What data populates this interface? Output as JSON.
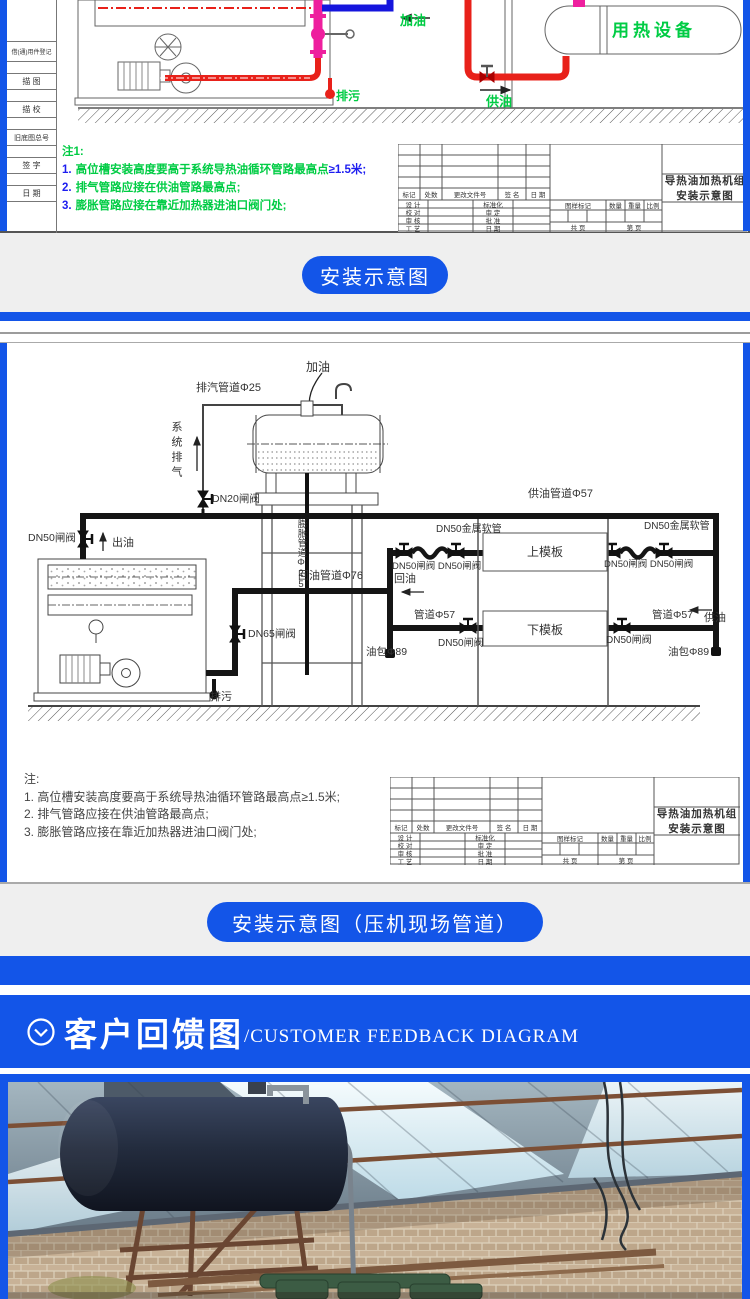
{
  "colors": {
    "accent_blue": "#1355e8",
    "diagram_green": "#00cc44",
    "note_blue": "#1d1df0",
    "pipe_red": "#e8211a",
    "pipe_magenta": "#ee1f9e",
    "pipe_blue": "#1515dd"
  },
  "drawing_frame": {
    "side_labels": [
      "借(通)用件登记",
      "描 图",
      "描 校",
      "旧底图总号",
      "签 字",
      "日 期"
    ]
  },
  "titleblock": {
    "row_header": [
      "标记",
      "处数",
      "更改文件号",
      "签 名",
      "日 期"
    ],
    "col_left": [
      "设 计",
      "校 对",
      "审 核",
      "工 艺"
    ],
    "col_mid": [
      "标准化",
      "审 定",
      "批 准",
      "日 期"
    ],
    "mark_header": [
      "图样标记",
      "数量",
      "重量",
      "比例"
    ],
    "pages": [
      "共  页",
      "第  页"
    ],
    "title": "导热油加热机组安装示意图"
  },
  "diagram1": {
    "labels": {
      "add_oil": "加油",
      "drain": "排污",
      "supply_oil": "供油",
      "heat_device": "用热设备"
    },
    "notes": {
      "head": "注1:",
      "n1": "1.",
      "t1": "高位槽安装高度要高于系统导热油循环管路最高点",
      "hl1": "≥1.5米;",
      "n2": "2.",
      "t2": "排气管路应接在供油管路最高点;",
      "n3": "3.",
      "t3": "膨胀管路应接在靠近加热器进油口阀门处;"
    }
  },
  "button1": {
    "label": "安装示意图"
  },
  "diagram2": {
    "labels": {
      "add_oil": "加油",
      "exhaust_pipe": "排汽管道Φ25",
      "system_vent": "系统排气",
      "dn20_valve": "DN20闸阀",
      "dn50_valve": "DN50闸阀",
      "out_oil": "出油",
      "expansion_pipe": "膨胀管道Φ25",
      "supply_pipe": "供油管道Φ57",
      "flex_hose": "DN50金属软管",
      "upper_mold": "上模板",
      "lower_mold": "下模板",
      "dn50_pair": "DN50闸阀 DN50闸阀",
      "return_oil": "回油",
      "return_pipe": "回油管道Φ76",
      "pipe57": "管道Φ57",
      "dn65_valve": "DN65闸阀",
      "oil_pocket": "油包Φ89",
      "drain": "排污",
      "supply_oil": "供油"
    },
    "notes": {
      "head": "注:",
      "items": [
        "1. 高位槽安装高度要高于系统导热油循环管路最高点≥1.5米;",
        "2. 排气管路应接在供油管路最高点;",
        "3. 膨胀管路应接在靠近加热器进油口阀门处;"
      ]
    }
  },
  "button2": {
    "label": "安装示意图（压机现场管道）"
  },
  "feedback_header": {
    "title_cn": "客户回馈图",
    "title_en": "/CUSTOMER FEEDBACK DIAGRAM"
  }
}
